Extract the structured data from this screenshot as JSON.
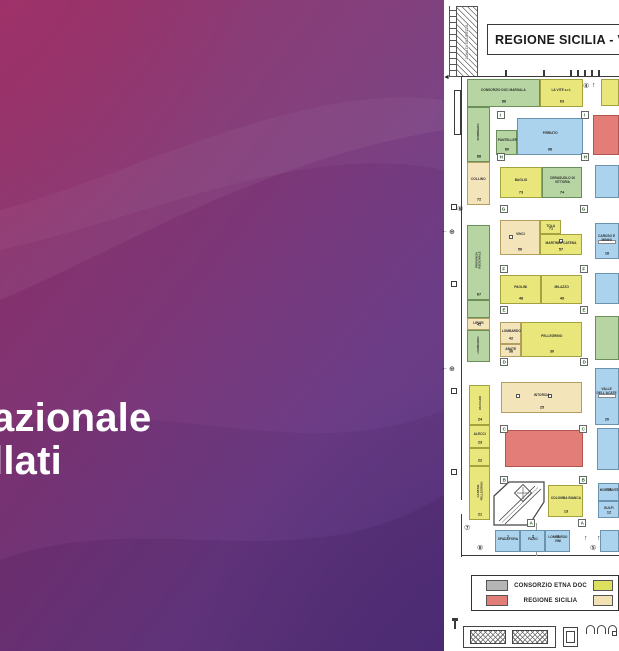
{
  "left_panel": {
    "title_line1": "azionale",
    "title_line2": "llati"
  },
  "plan": {
    "header_title": "REGIONE SICILIA  -  V",
    "security_zone_label": "ZONA DI SICUREZZA",
    "palette": {
      "green": "#b6d5a3",
      "yellow": "#e9e77b",
      "tan": "#f4e4b9",
      "blue": "#abd3ee",
      "red": "#e37d78",
      "gray": "#b5b5b5",
      "legend_yellow": "#dde05e",
      "legend_tan": "#f2e1b2"
    },
    "booths": [
      {
        "x": 467,
        "y": 79,
        "w": 73,
        "h": 28,
        "color": "green",
        "label": "CONSORZIO DOC MARSALA",
        "num": "86"
      },
      {
        "x": 540,
        "y": 79,
        "w": 43,
        "h": 28,
        "color": "yellow",
        "label": "LA VITE s.r.l.",
        "num": "63"
      },
      {
        "x": 601,
        "y": 79,
        "w": 18,
        "h": 27,
        "color": "yellow",
        "label": "",
        "num": ""
      },
      {
        "x": 467,
        "y": 107,
        "w": 23,
        "h": 55,
        "color": "green",
        "label": "SOMBRERO",
        "num": "88",
        "vert": true
      },
      {
        "x": 467,
        "y": 162,
        "w": 23,
        "h": 43,
        "color": "tan",
        "label": "COLLINO",
        "num": "72"
      },
      {
        "x": 467,
        "y": 225,
        "w": 23,
        "h": 75,
        "color": "green",
        "label": "PROVINCIA REGIONALE",
        "num": "67",
        "vert": true
      },
      {
        "x": 467,
        "y": 300,
        "w": 23,
        "h": 18,
        "color": "green",
        "label": "",
        "num": ""
      },
      {
        "x": 467,
        "y": 318,
        "w": 23,
        "h": 12,
        "color": "tan",
        "label": "LIPARI",
        "num": "41"
      },
      {
        "x": 467,
        "y": 330,
        "w": 23,
        "h": 32,
        "color": "green",
        "label": "LOMBARDO",
        "num": "",
        "vert": true
      },
      {
        "x": 469,
        "y": 385,
        "w": 21,
        "h": 40,
        "color": "yellow",
        "label": "VACCARO",
        "num": "24",
        "vert": true
      },
      {
        "x": 469,
        "y": 425,
        "w": 21,
        "h": 23,
        "color": "yellow",
        "label": "ALECCI",
        "num": "23"
      },
      {
        "x": 469,
        "y": 448,
        "w": 21,
        "h": 18,
        "color": "yellow",
        "label": "",
        "num": "22"
      },
      {
        "x": 469,
        "y": 466,
        "w": 21,
        "h": 54,
        "color": "yellow",
        "label": "CANTINE PELLEGRINO",
        "num": "21",
        "vert": true
      },
      {
        "x": 496,
        "y": 130,
        "w": 21,
        "h": 25,
        "color": "green",
        "label": "PANTELLERIA",
        "num": "80"
      },
      {
        "x": 517,
        "y": 118,
        "w": 66,
        "h": 37,
        "color": "blue",
        "label": "FIRRIATO",
        "num": "96"
      },
      {
        "x": 593,
        "y": 115,
        "w": 26,
        "h": 40,
        "color": "red",
        "label": "",
        "num": ""
      },
      {
        "x": 500,
        "y": 167,
        "w": 42,
        "h": 31,
        "color": "yellow",
        "label": "BAGLIO",
        "num": "73"
      },
      {
        "x": 542,
        "y": 167,
        "w": 40,
        "h": 31,
        "color": "green",
        "label": "CERASUOLO DI VITTORIA",
        "num": "74"
      },
      {
        "x": 595,
        "y": 165,
        "w": 24,
        "h": 33,
        "color": "blue",
        "label": "",
        "num": ""
      },
      {
        "x": 500,
        "y": 220,
        "w": 40,
        "h": 35,
        "color": "tan",
        "label": "VINCI",
        "num": "56",
        "doors": [
          [
            8,
            14
          ]
        ]
      },
      {
        "x": 540,
        "y": 220,
        "w": 21,
        "h": 14,
        "color": "yellow",
        "label": "TOLA",
        "num": "71"
      },
      {
        "x": 540,
        "y": 234,
        "w": 42,
        "h": 21,
        "color": "yellow",
        "label": "MARTINEZ CATENA",
        "num": "57",
        "doors": [
          [
            18,
            4
          ]
        ]
      },
      {
        "x": 595,
        "y": 223,
        "w": 24,
        "h": 36,
        "color": "blue",
        "label": "CARUSO E MININI",
        "num": "16",
        "band": true
      },
      {
        "x": 500,
        "y": 275,
        "w": 41,
        "h": 29,
        "color": "yellow",
        "label": "PAOLINI",
        "num": "48"
      },
      {
        "x": 541,
        "y": 275,
        "w": 41,
        "h": 29,
        "color": "yellow",
        "label": "MILAZZO",
        "num": "49"
      },
      {
        "x": 595,
        "y": 273,
        "w": 24,
        "h": 31,
        "color": "blue",
        "label": "",
        "num": ""
      },
      {
        "x": 500,
        "y": 322,
        "w": 21,
        "h": 22,
        "color": "tan",
        "label": "LOMBARDO",
        "num": "42"
      },
      {
        "x": 500,
        "y": 344,
        "w": 21,
        "h": 13,
        "color": "tan",
        "label": "ABATE",
        "num": "36"
      },
      {
        "x": 521,
        "y": 322,
        "w": 61,
        "h": 35,
        "color": "yellow",
        "label": "PELLEGRINO",
        "num": "30"
      },
      {
        "x": 595,
        "y": 316,
        "w": 24,
        "h": 44,
        "color": "green",
        "label": "",
        "num": ""
      },
      {
        "x": 501,
        "y": 382,
        "w": 81,
        "h": 31,
        "color": "tan",
        "label": "INTORCIA",
        "num": "25",
        "doors": [
          [
            14,
            11
          ],
          [
            46,
            11
          ]
        ]
      },
      {
        "x": 595,
        "y": 368,
        "w": 24,
        "h": 57,
        "color": "blue",
        "label": "VALLE DELL'ACATE",
        "num": "20",
        "band": true
      },
      {
        "x": 505,
        "y": 430,
        "w": 78,
        "h": 37,
        "color": "red",
        "label": "",
        "num": ""
      },
      {
        "x": 597,
        "y": 428,
        "w": 22,
        "h": 42,
        "color": "blue",
        "label": "",
        "num": ""
      },
      {
        "x": 548,
        "y": 485,
        "w": 35,
        "h": 32,
        "color": "yellow",
        "label": "COLOMBA BIANCA",
        "num": "13"
      },
      {
        "x": 598,
        "y": 483,
        "w": 21,
        "h": 18,
        "color": "blue",
        "label": "MORGANTE",
        "num": "14",
        "numTop": true
      },
      {
        "x": 598,
        "y": 501,
        "w": 21,
        "h": 17,
        "color": "blue",
        "label": "GULFI",
        "num": "12"
      },
      {
        "x": 495,
        "y": 530,
        "w": 25,
        "h": 22,
        "color": "blue",
        "label": "SPADAFORA",
        "num": "1",
        "numTop": true
      },
      {
        "x": 520,
        "y": 530,
        "w": 25,
        "h": 22,
        "color": "blue",
        "label": "FAZIO",
        "num": "2",
        "numTop": true
      },
      {
        "x": 545,
        "y": 530,
        "w": 25,
        "h": 22,
        "color": "blue",
        "label": "LOMBARDO VINI",
        "num": "3",
        "numTop": true
      },
      {
        "x": 600,
        "y": 530,
        "w": 19,
        "h": 22,
        "color": "blue",
        "label": "",
        "num": ""
      }
    ],
    "aisle_markers": [
      {
        "letter": "I",
        "x": 497,
        "y": 111
      },
      {
        "letter": "I",
        "x": 581,
        "y": 111
      },
      {
        "letter": "H",
        "x": 497,
        "y": 153
      },
      {
        "letter": "H",
        "x": 581,
        "y": 153
      },
      {
        "letter": "G",
        "x": 500,
        "y": 205
      },
      {
        "letter": "G",
        "x": 580,
        "y": 205
      },
      {
        "letter": "F",
        "x": 500,
        "y": 265
      },
      {
        "letter": "F",
        "x": 580,
        "y": 265
      },
      {
        "letter": "E",
        "x": 500,
        "y": 306
      },
      {
        "letter": "E",
        "x": 580,
        "y": 306
      },
      {
        "letter": "D",
        "x": 500,
        "y": 358
      },
      {
        "letter": "D",
        "x": 580,
        "y": 358
      },
      {
        "letter": "C",
        "x": 500,
        "y": 425
      },
      {
        "letter": "C",
        "x": 579,
        "y": 425
      },
      {
        "letter": "B",
        "x": 500,
        "y": 476
      },
      {
        "letter": "B",
        "x": 579,
        "y": 476
      },
      {
        "letter": "A",
        "x": 527,
        "y": 519
      },
      {
        "letter": "A",
        "x": 578,
        "y": 519
      }
    ],
    "symbols": [
      {
        "glyph": "④",
        "x": 583,
        "y": 83
      },
      {
        "glyph": "↑",
        "x": 592,
        "y": 82
      },
      {
        "glyph": "◄",
        "x": 443,
        "y": 74
      },
      {
        "glyph": "⑥",
        "x": 457,
        "y": 206
      },
      {
        "glyph": "←",
        "x": 441,
        "y": 228
      },
      {
        "glyph": "⊕",
        "x": 449,
        "y": 229
      },
      {
        "glyph": "←",
        "x": 441,
        "y": 365
      },
      {
        "glyph": "⊕",
        "x": 449,
        "y": 366
      },
      {
        "glyph": "⑦",
        "x": 464,
        "y": 525
      },
      {
        "glyph": "⑧",
        "x": 477,
        "y": 545
      },
      {
        "glyph": "↑",
        "x": 584,
        "y": 535
      },
      {
        "glyph": "↑",
        "x": 597,
        "y": 535
      },
      {
        "glyph": "⑤",
        "x": 590,
        "y": 545
      }
    ],
    "legend": {
      "rows": [
        {
          "swatch": "gray",
          "label": "CONSORZIO ETNA DOC",
          "right_swatch": "legend_yellow"
        },
        {
          "swatch": "red",
          "label": "REGIONE SICILIA",
          "right_swatch": "legend_tan"
        }
      ]
    }
  }
}
